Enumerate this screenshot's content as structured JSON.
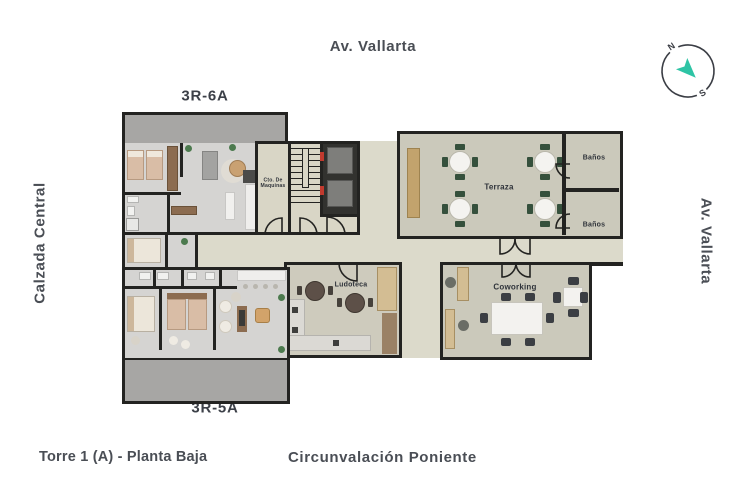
{
  "page": {
    "background": "#ffffff"
  },
  "streets": {
    "top": "Av. Vallarta",
    "left": "Calzada Central",
    "right": "Av. Vallarta",
    "bottom": "Circunvalación Poniente"
  },
  "title": "Torre 1 (A) - Planta Baja",
  "units": {
    "top_unit": {
      "label": "3R-6A"
    },
    "bottom_unit": {
      "label": "3R-5A"
    }
  },
  "rooms": {
    "machine_room": {
      "line1": "Cto. De",
      "line2": "Maquinas"
    },
    "terrace": {
      "label": "Terraza"
    },
    "bathroom_top": {
      "label": "Baños"
    },
    "bathroom_bottom": {
      "label": "Baños"
    },
    "playroom": {
      "label": "Ludoteca"
    },
    "coworking": {
      "label": "Coworking"
    }
  },
  "compass": {
    "north": "N",
    "south": "S"
  },
  "colors": {
    "label_text": "#4a4e55",
    "wall": "#232321",
    "plaza_floor": "#dcdacb",
    "amenity_floor": "#cbc9bb",
    "unit_floor": "#d5d4d2",
    "patio_floor": "#a7a6a4",
    "wood": "#c2a36d",
    "chair_green": "#35503c",
    "elevator_cab": "#7e7e7b",
    "accent_red": "#c13a2e",
    "compass_arrow": "#2ec4a5"
  }
}
